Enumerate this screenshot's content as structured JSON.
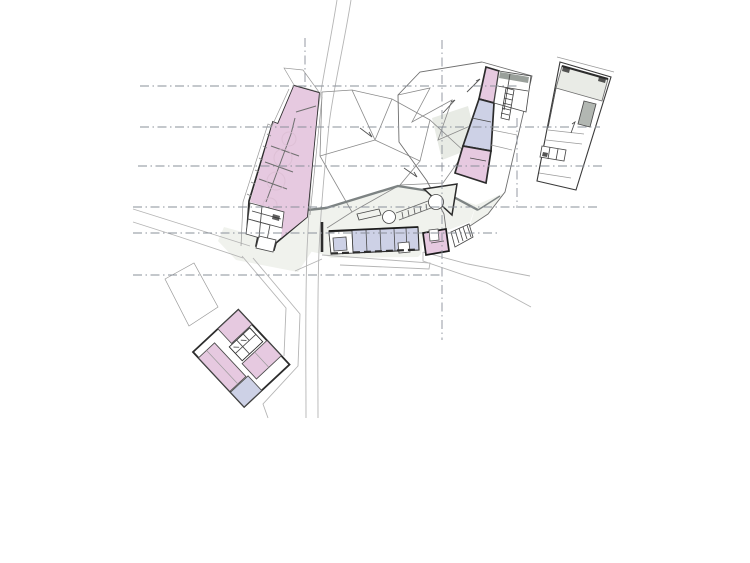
{
  "page": {
    "kind": "architectural-site-plan",
    "description": "Black-and-white site plan with pink and lavender room fills, dash-dot survey gridlines and a curving north-south road"
  },
  "colors": {
    "paper_white": "#ffffff",
    "room_pink": "#e6c9e0",
    "room_lavender": "#cdd1e6",
    "ground_tint": "#f0f2ed",
    "facet_tint": "#e8ebe5",
    "roof_grey": "#e9ebe6",
    "block_grey": "#b2b7b2",
    "band_dark_grey": "#9aa09b",
    "wall_dark": "#2c2c2c",
    "wall_medium": "#7d8383",
    "line_thin": "#9a9a9a",
    "line_path": "#b5b5b5",
    "gridline": "#8a909a"
  },
  "buildings": [
    {
      "id": "long-gallery-building",
      "fill": "room_pink",
      "note": "tapered bar, upper left, spine with cross ties"
    },
    {
      "id": "gallery-annex-rooms",
      "fill": "paper_white",
      "note": "small service rooms at gallery south end"
    },
    {
      "id": "museum-strip-north-room",
      "fill": "room_pink"
    },
    {
      "id": "museum-strip-hall",
      "fill": "room_lavender"
    },
    {
      "id": "museum-strip-south-room",
      "fill": "room_pink"
    },
    {
      "id": "museum-east-rooms",
      "fill": "paper_white",
      "note": "white cells with hatched stair"
    },
    {
      "id": "east-block-building",
      "fill": "paper_white",
      "note": "far right, grey roof band"
    },
    {
      "id": "bar-building",
      "fill": "room_lavender",
      "note": "long low bar on plaza, dashed glazed south wall"
    },
    {
      "id": "kiosk-building",
      "fill": "room_pink"
    },
    {
      "id": "stair-strip",
      "fill": "paper_white"
    },
    {
      "id": "pavilion-triangle",
      "fill": "ground_tint"
    },
    {
      "id": "courtyard-house",
      "fill": "paper_white",
      "note": "rotated square, pink wings, lavender corner room"
    }
  ],
  "site": {
    "gridlines_horizontal": [
      {
        "y": 86,
        "x1": 140,
        "x2": 520
      },
      {
        "y": 127,
        "x1": 140,
        "x2": 600
      },
      {
        "y": 166,
        "x1": 138,
        "x2": 603
      },
      {
        "y": 207,
        "x1": 133,
        "x2": 600
      },
      {
        "y": 233,
        "x1": 133,
        "x2": 500
      },
      {
        "y": 275,
        "x1": 133,
        "x2": 443
      }
    ],
    "gridlines_vertical": [
      {
        "x": 305,
        "y1": 38,
        "y2": 88
      },
      {
        "x": 442,
        "y1": 40,
        "y2": 340
      },
      {
        "x": 517,
        "y1": 118,
        "y2": 208
      }
    ],
    "paths": [
      {
        "name": "road-west-edge",
        "d": "M337,0 C329,50 320,90 316,125 C312,165 309,205 307,250 C305,305 306,365 306,418"
      },
      {
        "name": "road-east-edge",
        "d": "M351,0 C343,50 333,90 329,125 C325,165 321,205 319,250 C317,305 318,365 318,418"
      },
      {
        "name": "footpath-west-upper",
        "d": "M133,209 L187,226 L250,246"
      },
      {
        "name": "footpath-west-lower",
        "d": "M133,222 L180,237 L243,258"
      },
      {
        "name": "footpath-around-courtyard-outer",
        "d": "M253,258 L300,314 L298,366 L263,404 L268,418"
      },
      {
        "name": "footpath-around-courtyard-inner",
        "d": "M242,256 L286,308 L284,356"
      },
      {
        "name": "road-southeast-upper",
        "d": "M423,252 L468,264 L530,276"
      },
      {
        "name": "road-southeast-lower",
        "d": "M423,252 L423,261 L487,283 L531,307"
      },
      {
        "name": "plaza-sidewalk-edge",
        "d": "M322,255 L430,263 L429,269 L340,265"
      },
      {
        "name": "footpath-annex",
        "d": "M295,271 L322,259"
      }
    ]
  }
}
